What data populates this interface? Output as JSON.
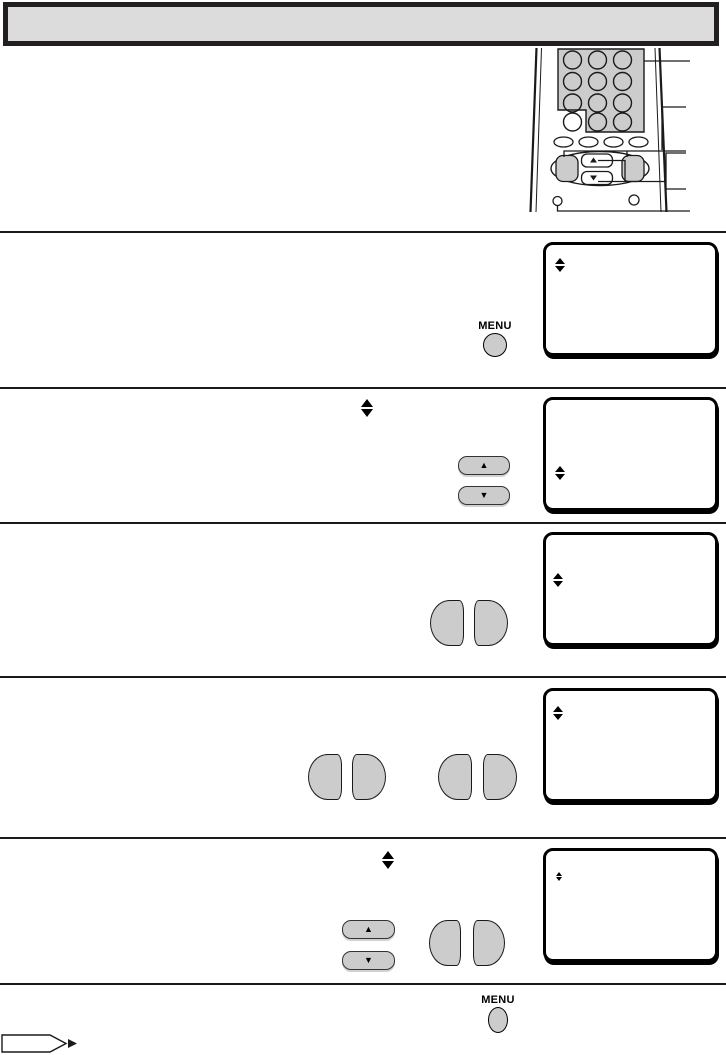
{
  "header": {
    "title": ""
  },
  "labels": {
    "menu": "MENU"
  },
  "symbols": {
    "up": "▲",
    "down": "▼"
  },
  "colors": {
    "header_fill": "#dcdcdc",
    "ink": "#1a1a1a",
    "button_gray": "#cccccc",
    "screen_border": "#000000",
    "page_bg": "#ffffff"
  },
  "remote": {
    "number_pad": {
      "rows": 4,
      "columns": 3,
      "round_buttons": 12
    },
    "function_button_row": {
      "oval_buttons": 4
    },
    "nav_cluster": {
      "side_buttons": 2,
      "up_button_symbol": "▲",
      "down_button_symbol": "▼"
    },
    "bottom_small_buttons": 2,
    "callout_lines": 5
  },
  "sections": [
    {
      "id": 1,
      "step_controls": [
        "MENU button"
      ],
      "screen_icon": "up-down-arrows"
    },
    {
      "id": 2,
      "inline_icon": "up-down-arrows",
      "step_controls": [
        "up button",
        "down button"
      ],
      "screen_icon": "up-down-arrows"
    },
    {
      "id": 3,
      "step_controls": [
        "left button",
        "right button"
      ],
      "screen_icon": "up-down-arrows"
    },
    {
      "id": 4,
      "step_controls": [
        "left button",
        "right button",
        "left button",
        "right button"
      ],
      "screen_icon": "up-down-arrows"
    },
    {
      "id": 5,
      "inline_icon": "up-down-arrows",
      "step_controls": [
        "up button",
        "down button",
        "left button",
        "right button"
      ],
      "screen_icon": "up-down-arrows"
    },
    {
      "id": 6,
      "step_controls": [
        "MENU button"
      ],
      "footer_marker": "continued-arrow"
    }
  ]
}
